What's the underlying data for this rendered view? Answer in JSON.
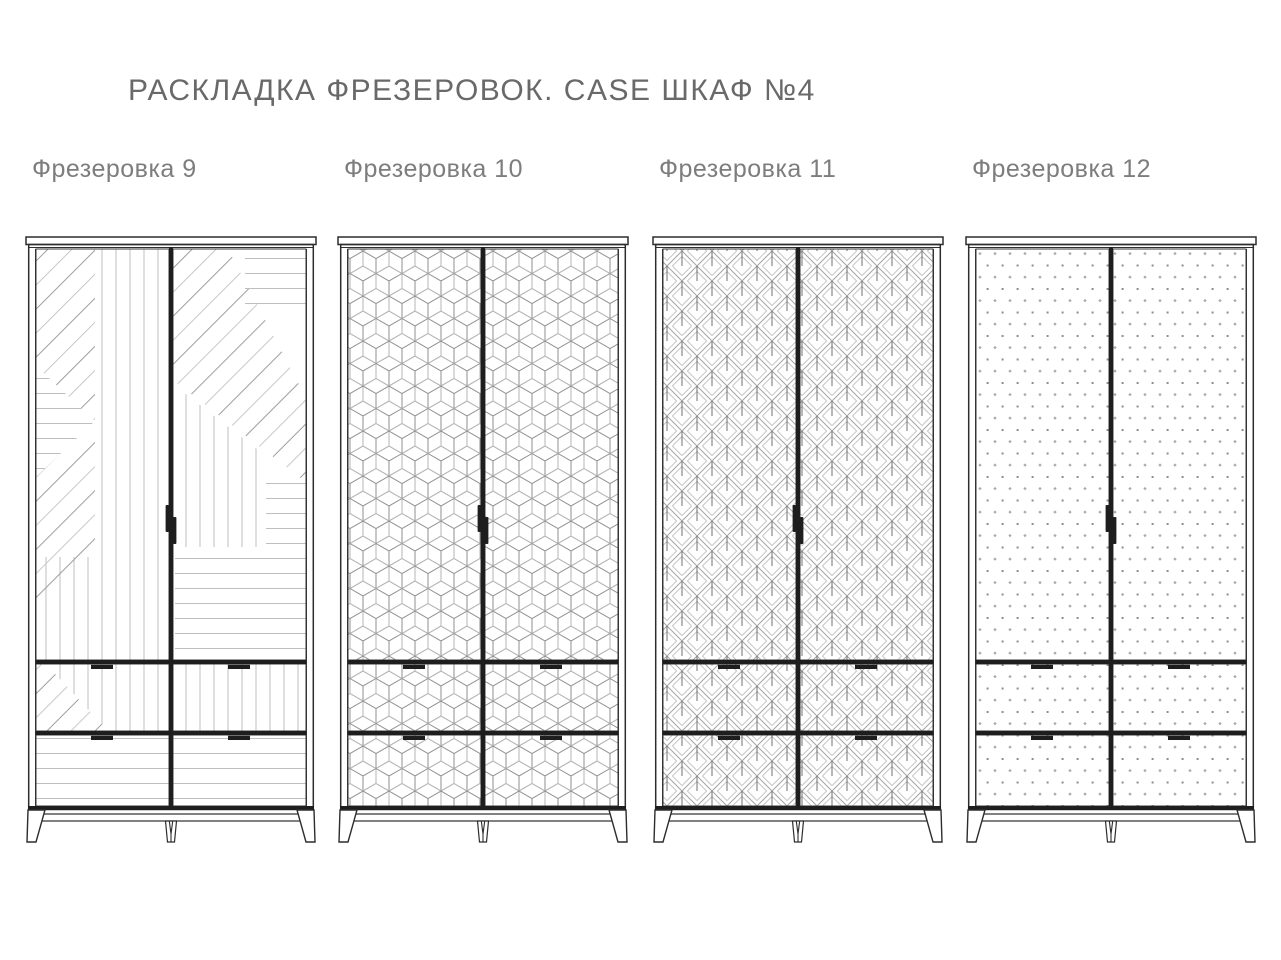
{
  "title": "РАСКЛАДКА ФРЕЗЕРОВОК. CASE ШКАФ №4",
  "wardrobes": [
    {
      "label": "Фрезеровка 9",
      "pattern": "geometric-stripes"
    },
    {
      "label": "Фрезеровка 10",
      "pattern": "isometric-cubes"
    },
    {
      "label": "Фрезеровка 11",
      "pattern": "deco-leaves"
    },
    {
      "label": "Фрезеровка 12",
      "pattern": "dot-grid"
    }
  ],
  "layout_positions_px": {
    "figure_lefts": [
      25,
      337,
      652,
      965
    ],
    "figure_top": 155
  },
  "colors": {
    "background": "#ffffff",
    "title_text": "#696969",
    "label_text": "#7d7d7d",
    "frame_ink": "#2d2d2d",
    "divider_ink": "#1e1e1e",
    "outline_ink": "#3a3a3a",
    "pattern_light": "#c9c9c9",
    "pattern_mid": "#bfbfbf",
    "pattern_dark": "#9e9e9e",
    "cube_line": "#b6b6b6",
    "cube_inner": "#8f8f8f",
    "leaf_outer": "#a3a3a3",
    "leaf_inner": "#c6c6c6",
    "leaf_stem": "#707070",
    "dot_square": "#8d8d8d",
    "dot_diamond": "#ababab"
  }
}
